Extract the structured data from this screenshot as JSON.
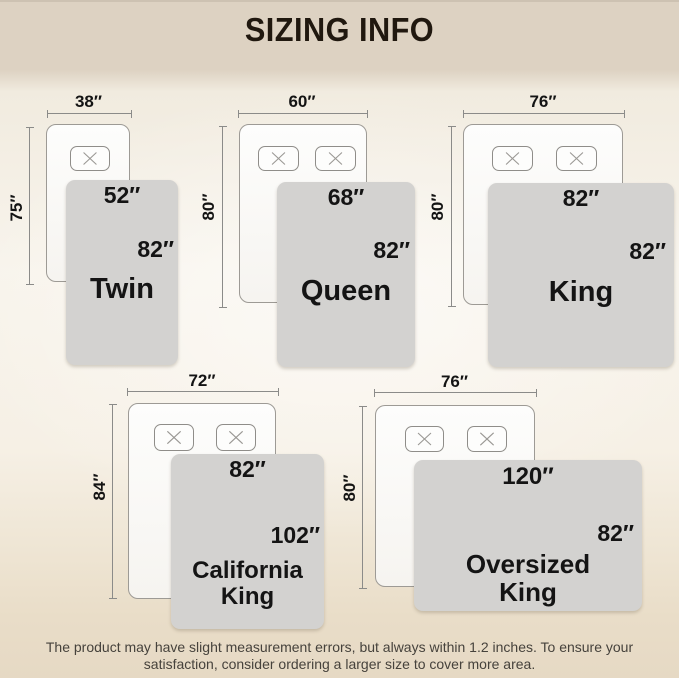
{
  "title": "SIZING INFO",
  "sizes": [
    {
      "name": "Twin",
      "top_width": "38″",
      "side_length": "75″",
      "blanket_width": "52″",
      "blanket_length": "82″",
      "pillow_count": 1
    },
    {
      "name": "Queen",
      "top_width": "60″",
      "side_length": "80″",
      "blanket_width": "68″",
      "blanket_length": "82″",
      "pillow_count": 2
    },
    {
      "name": "King",
      "top_width": "76″",
      "side_length": "80″",
      "blanket_width": "82″",
      "blanket_length": "82″",
      "pillow_count": 2
    },
    {
      "name": "California King",
      "top_width": "72″",
      "side_length": "84″",
      "blanket_width": "82″",
      "blanket_length": "102″",
      "pillow_count": 2
    },
    {
      "name": "Oversized King",
      "top_width": "76″",
      "side_length": "80″",
      "blanket_width": "120″",
      "blanket_length": "82″",
      "pillow_count": 2
    }
  ],
  "footer": {
    "line1": "The product may have slight measurement errors, but always within 1.2 inches. To ensure your",
    "line2": "satisfaction, consider ordering a larger size to cover more area."
  },
  "colors": {
    "header_bg": "#ddd2c2",
    "top_strip": "#cdc2b2",
    "background_light": "#f8f4ec",
    "background_bottom": "#e6d9c4",
    "blanket_fill": "#d3d2d0",
    "bed_fill": "#fdfdfc",
    "bed_border": "#9d9a95",
    "dimension_line": "#8b8b89",
    "label_text": "#141414",
    "footer_text": "#46423c"
  }
}
